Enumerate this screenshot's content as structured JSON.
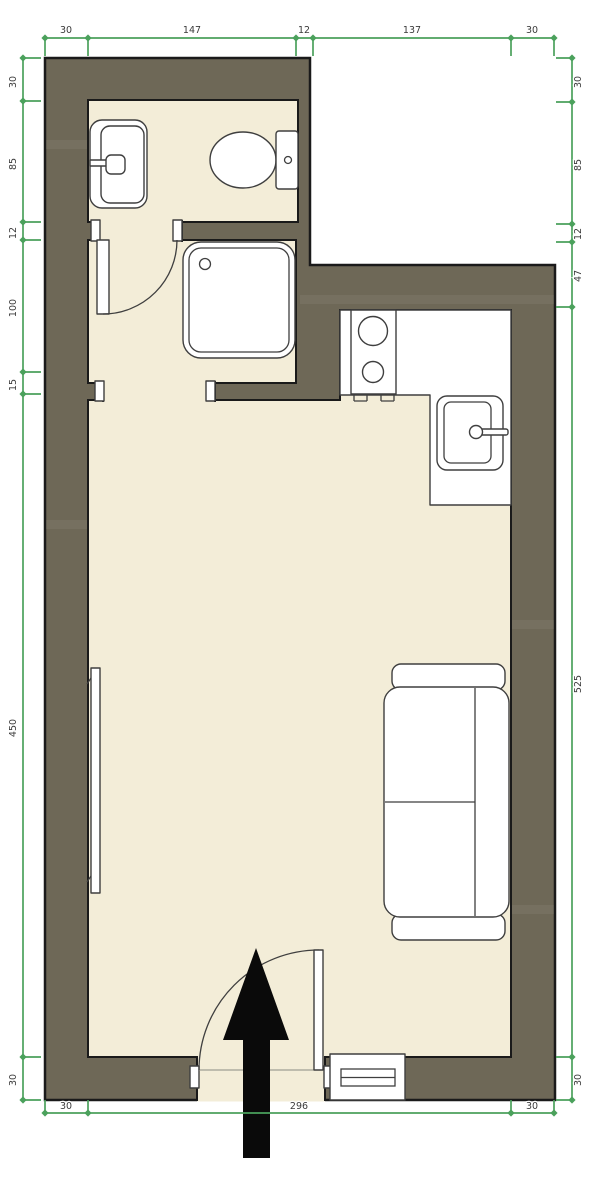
{
  "floorplan": {
    "colors": {
      "background": "#ffffff",
      "wall": "#6e6857",
      "wall_outline": "#1a1a1a",
      "floor": "#f3edd8",
      "fixture_fill": "#ffffff",
      "fixture_outline": "#3f3f3f",
      "dimension": "#4ba15c",
      "dimension_text": "#3b3b3b",
      "arrow": "#0a0a0a"
    },
    "dimensions": {
      "top": [
        "30",
        "147",
        "12",
        "137",
        "30"
      ],
      "left": [
        "30",
        "85",
        "12",
        "100",
        "15",
        "450",
        "30"
      ],
      "right": [
        "30",
        "85",
        "12",
        "47",
        "525",
        "30"
      ],
      "bottom": [
        "30",
        "296",
        "30"
      ]
    },
    "fixtures": [
      "washbasin",
      "toilet",
      "shower-tray",
      "interior-door",
      "kitchen-counter",
      "cooktop",
      "kitchen-sink",
      "radiator",
      "sofa",
      "window",
      "entrance-door",
      "entrance-arrow"
    ]
  }
}
